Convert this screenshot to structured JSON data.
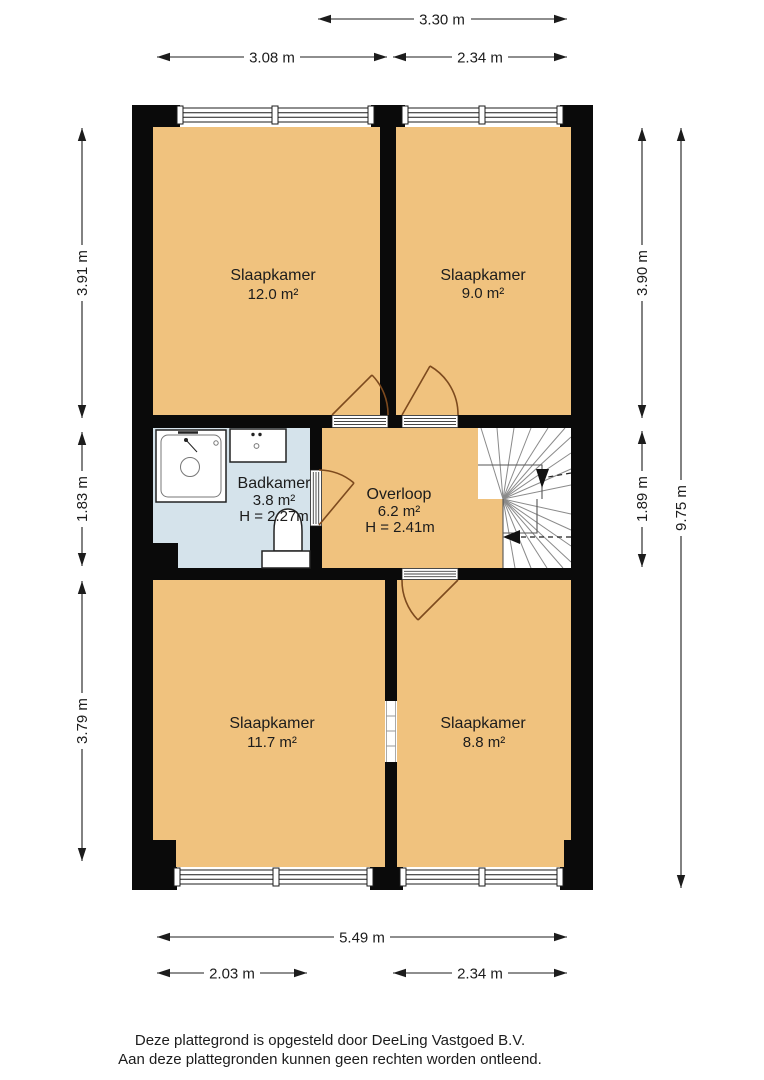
{
  "plan": {
    "rooms": [
      {
        "name": "Slaapkamer",
        "area": "12.0 m²"
      },
      {
        "name": "Slaapkamer",
        "area": "9.0 m²"
      },
      {
        "name": "Badkamer",
        "area": "3.8 m²",
        "height": "H = 2.27m"
      },
      {
        "name": "Overloop",
        "area": "6.2 m²",
        "height": "H = 2.41m"
      },
      {
        "name": "Slaapkamer",
        "area": "11.7 m²"
      },
      {
        "name": "Slaapkamer",
        "area": "8.8 m²"
      }
    ],
    "dimensions": {
      "top_overloop_width": "3.30 m",
      "top_left_width": "3.08 m",
      "top_right_width": "2.34 m",
      "bottom_total_width": "5.49 m",
      "bottom_left_width": "2.03 m",
      "bottom_right_width": "2.34 m",
      "left_top_height": "3.91 m",
      "left_middle_height": "1.83 m",
      "left_bottom_height": "3.79 m",
      "right_top_height": "3.90 m",
      "right_middle_height": "1.89 m",
      "right_total_height": "9.75 m"
    },
    "colors": {
      "floor": "#f0c27e",
      "bathroom_floor": "#d5e3eb",
      "wall": "#0a0a0a",
      "door": "#7d4a1e"
    }
  },
  "footer": {
    "line1": "Deze plattegrond is opgesteld door DeeLing Vastgoed B.V.",
    "line2": "Aan deze plattegronden kunnen geen rechten worden ontleend."
  }
}
